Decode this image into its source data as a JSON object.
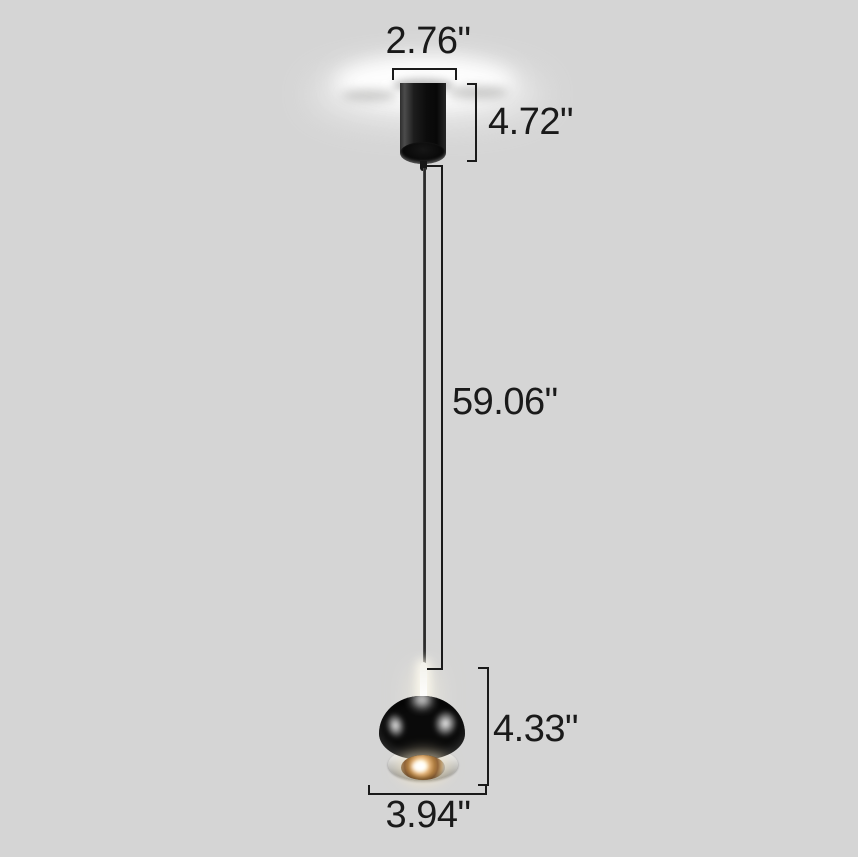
{
  "diagram": {
    "type": "pendant-light-dimension-diagram",
    "colors": {
      "background": "#d5d5d5",
      "annotation": "#1a1a1a",
      "lamp_black": "#0a0a0a",
      "chrome_base": "#c9c9c6",
      "lens_glow_warm": "#e2b277",
      "ceiling_glow": "#ffffff"
    }
  },
  "dimensions": {
    "canopy_width": "2.76\"",
    "canopy_height": "4.72\"",
    "cord_length": "59.06\"",
    "head_height": "4.33\"",
    "head_width": "3.94\""
  }
}
